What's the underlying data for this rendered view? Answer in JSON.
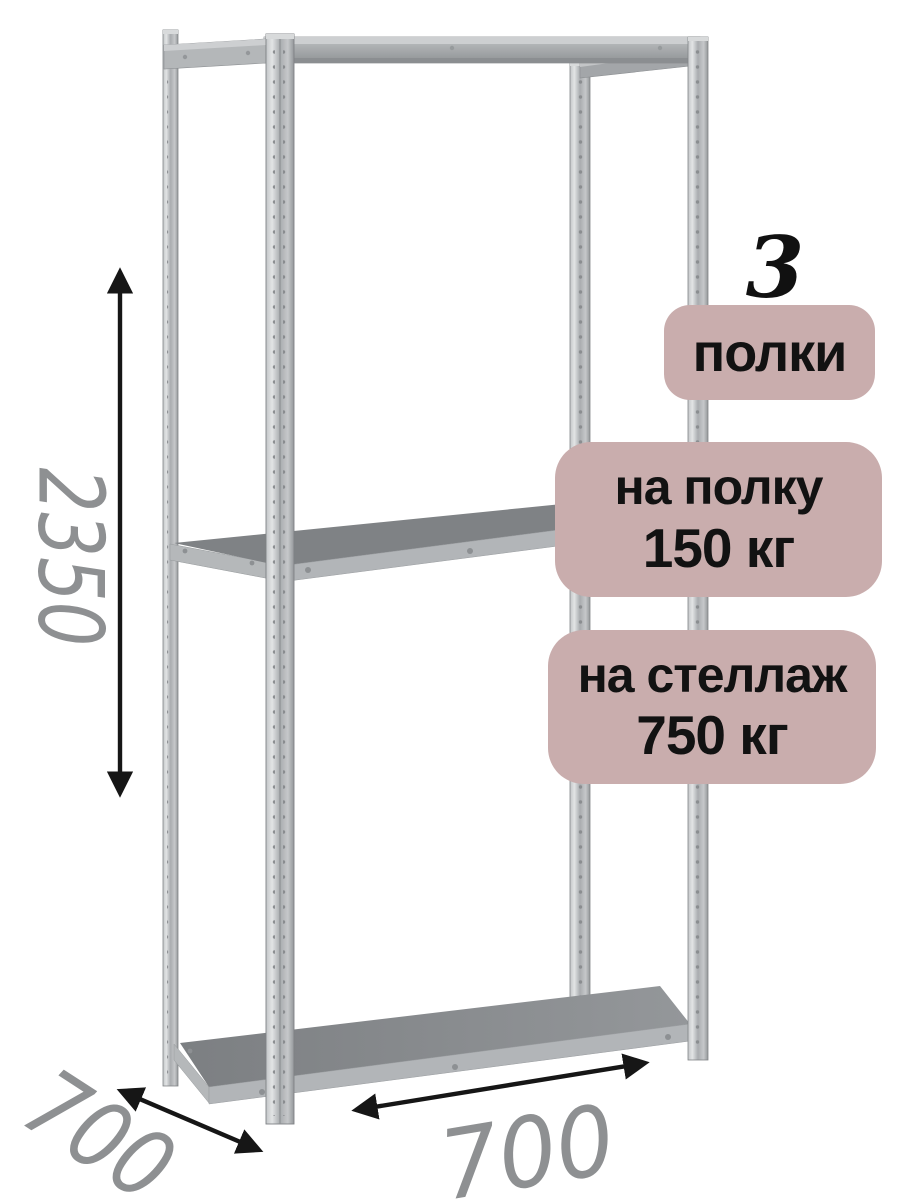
{
  "figure": {
    "subject": "metal-shelving-rack-product-illustration"
  },
  "badges": {
    "shelf_count": {
      "number": "3",
      "label": "полки"
    },
    "per_shelf": {
      "label": "на полку",
      "value": "150 кг"
    },
    "per_rack": {
      "label": "на стеллаж",
      "value": "750 кг"
    },
    "bg_color": "#c9adad",
    "text_color": "#121212"
  },
  "dimensions": {
    "height": "2350",
    "depth": "700",
    "width": "700",
    "text_color": "#8e9092",
    "arrow_color": "#161616"
  },
  "colors": {
    "background": "#ffffff",
    "metal_light": "#dcdedf",
    "metal_mid": "#a8abae",
    "shelf_top": "#7f8285",
    "shelf_edge": "#b2b5b8"
  }
}
